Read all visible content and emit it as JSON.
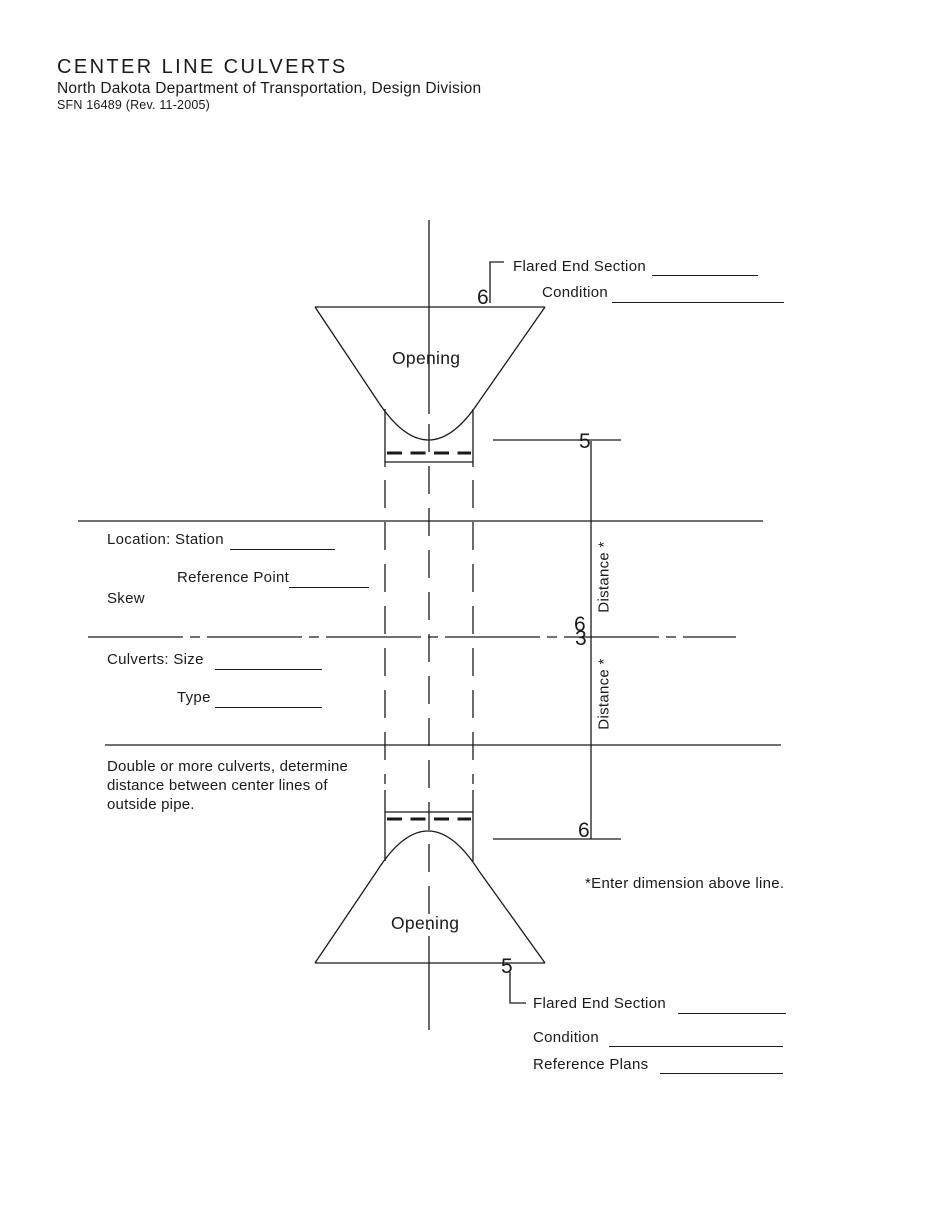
{
  "header": {
    "title": "CENTER LINE CULVERTS",
    "subtitle": "North Dakota Department of Transportation, Design Division",
    "form_number": "SFN 16489 (Rev. 11-2005)"
  },
  "top_section": {
    "flared_end_section_label": "Flared End Section",
    "flared_end_section_value": "",
    "condition_label": "Condition",
    "condition_value": "",
    "opening_label": "Opening",
    "ref_6": "6",
    "ref_5": "5"
  },
  "middle_section": {
    "location_station_label": "Location: Station",
    "station_value": "",
    "reference_point_label": "Reference Point",
    "reference_point_value": "",
    "skew_label": "Skew",
    "culverts_size_label": "Culverts: Size",
    "size_value": "",
    "type_label": "Type",
    "type_value": "",
    "distance_upper_label": "Distance *",
    "distance_lower_label": "Distance *",
    "ref_6": "6",
    "ref_3": "3",
    "note_lines": [
      "Double or more culverts, determine",
      "distance between center lines of",
      "outside pipe."
    ]
  },
  "bottom_section": {
    "opening_label": "Opening",
    "ref_6": "6",
    "ref_5": "5",
    "footnote": "*Enter dimension above line.",
    "flared_end_section_label": "Flared End Section",
    "flared_end_section_value": "",
    "condition_label": "Condition",
    "condition_value": "",
    "reference_plans_label": "Reference Plans",
    "reference_plans_value": ""
  },
  "colors": {
    "ink": "#1a1a1a",
    "paper": "#ffffff"
  }
}
